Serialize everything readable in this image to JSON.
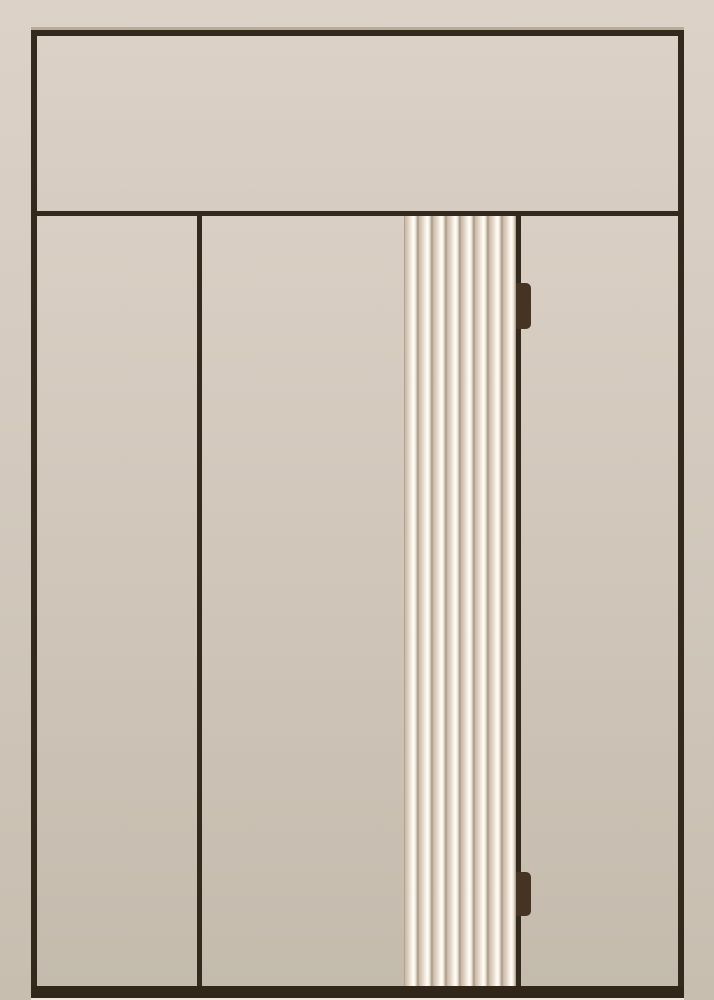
{
  "scene": {
    "kind": "door-elevation-illustration",
    "description": "Flat beige elevation of a door unit with transom, fluted center strip, door edge line, two hinges and threshold bar",
    "text_content": "none"
  },
  "structure": {
    "transom": "transom-panel",
    "panels": [
      "left-panel",
      "middle-panel",
      "fluted-panel",
      "right-panel"
    ],
    "dividers": [
      "transom-divider-line",
      "mullion-line",
      "door-edge-line"
    ],
    "hinges": [
      "hinge-top",
      "hinge-bottom"
    ],
    "threshold": "bottom-threshold-bar",
    "floor": "floor-highlight-strip"
  },
  "fluted_panel": {
    "flute_count": 8
  },
  "colors": {
    "bg-top": "#dcd2c8",
    "bg-bottom": "#c7beb0",
    "panel-top": "#d9cfc4",
    "panel-bottom": "#c4bbad",
    "transom-top": "#dbd1c7",
    "transom-bottom": "#d6ccc1",
    "frame-line": "#33291d",
    "bottom-bar": "#32261a",
    "floor-strip": "#ece6dc",
    "bevel": "#9d8d6c",
    "hinge": "#453423",
    "flute-shadow": "#a8947f",
    "flute-mid": "#ddd1c2",
    "flute-highlight": "#fffdf6"
  }
}
